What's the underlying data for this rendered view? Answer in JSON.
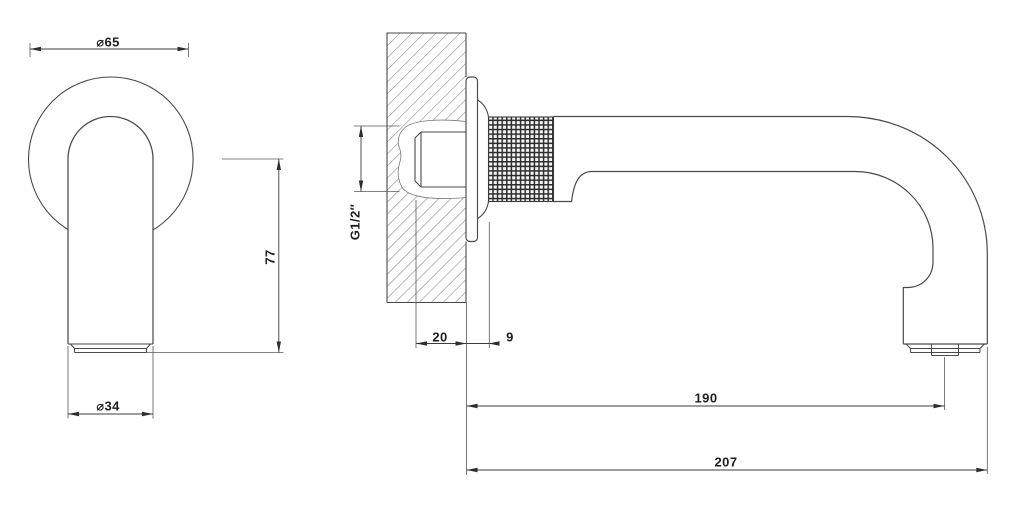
{
  "drawing": {
    "colors": {
      "background": "#ffffff",
      "line": "#4a4a4a",
      "dim_line": "#3e3e3e",
      "text": "#1e1e1e"
    },
    "dimensions": {
      "flange_diameter": "⌀65",
      "tip_height": "77",
      "spout_diameter": "⌀34",
      "thread_size": "G1/2″",
      "recess_depth": "20",
      "flange_projection": "9",
      "reach_to_aerator": "190",
      "total_projection": "207"
    }
  }
}
